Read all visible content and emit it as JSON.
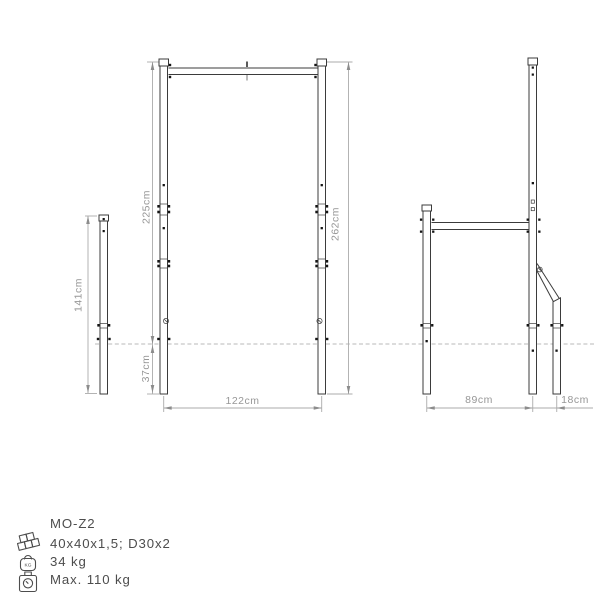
{
  "product": {
    "model": "MO-Z2",
    "profile_spec": "40x40x1,5; D30x2",
    "weight": "34 kg",
    "max_load": "Max. 110 kg"
  },
  "spec_icons": {
    "profiles": "steel-profiles-icon",
    "weight": "weight-kg-icon",
    "weight_label": "KG",
    "max_load": "scale-icon"
  },
  "dimensions": {
    "rear_post_length": "141cm",
    "height_above_ground": "225cm",
    "total_height": "262cm",
    "anchor_depth": "37cm",
    "front_width": "122cm",
    "side_depth": "89cm",
    "brace_offset": "18cm"
  },
  "colors": {
    "background": "#ffffff",
    "structure": "#3b3b3b",
    "dimension_line": "#ababab",
    "dimension_text": "#979797",
    "ground_line": "#b8b8b8",
    "spec_text": "#4d4d4d"
  }
}
